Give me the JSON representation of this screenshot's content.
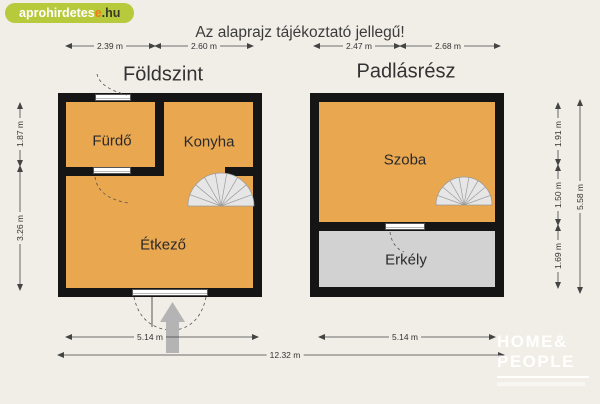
{
  "badge": {
    "main": "aprohirdetes",
    "accent": "e",
    "suffix": ".hu"
  },
  "title": "Az alaprajz tájékoztató jellegű!",
  "left_plan": {
    "title": "Földszint",
    "rooms": {
      "bathroom": "Fürdő",
      "kitchen": "Konyha",
      "dining": "Étkező"
    },
    "dims": {
      "top1": "2.39 m",
      "top2": "2.60 m",
      "side1": "1.87 m",
      "side2": "3.26 m",
      "bottom": "5.14 m"
    }
  },
  "right_plan": {
    "title": "Padlásrész",
    "rooms": {
      "room": "Szoba",
      "balcony": "Erkély"
    },
    "dims": {
      "top1": "2.47 m",
      "top2": "2.68 m",
      "side1": "1.91 m",
      "side2": "1.50 m",
      "side3": "1.69 m",
      "side_total": "5.58 m",
      "bottom": "5.14 m"
    }
  },
  "total_width": "12.32 m",
  "logo": {
    "line1": "HOME&",
    "line2": "PEOPLE"
  },
  "colors": {
    "background": "#f0eee7",
    "room_fill": "#e9a750",
    "balcony_fill": "#d2d2d2",
    "wall": "#151515",
    "badge_green": "#b6ca3c",
    "badge_orange": "#ee7d18",
    "stair_fill": "#e6e6e6",
    "entrance_arrow": "#b4b4b4"
  }
}
